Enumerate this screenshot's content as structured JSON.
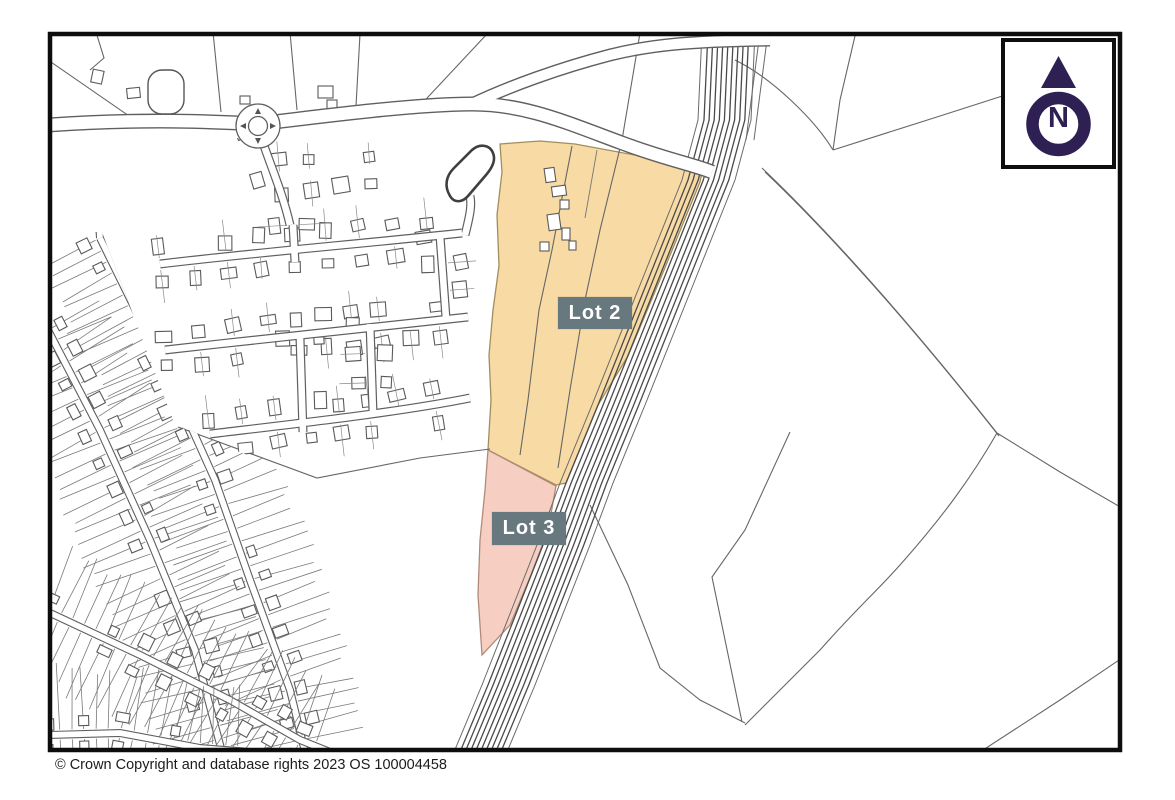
{
  "map": {
    "copyright": "© Crown Copyright and database rights 2023 OS 100004458",
    "border_color": "#0d0d0d",
    "line_color": "#606060",
    "railway_color": "#4a4a4a"
  },
  "lots": [
    {
      "id": "lot2",
      "label": "Lot 2",
      "fill": "#f8dba4",
      "edge": "#a28d5d"
    },
    {
      "id": "lot3",
      "label": "Lot 3",
      "fill": "#f7cfc2",
      "edge": "#b08a7a"
    }
  ],
  "labels": {
    "box_color": "#67787f",
    "text_color": "#ffffff"
  },
  "north": {
    "letter": "N",
    "color": "#2e2052"
  }
}
